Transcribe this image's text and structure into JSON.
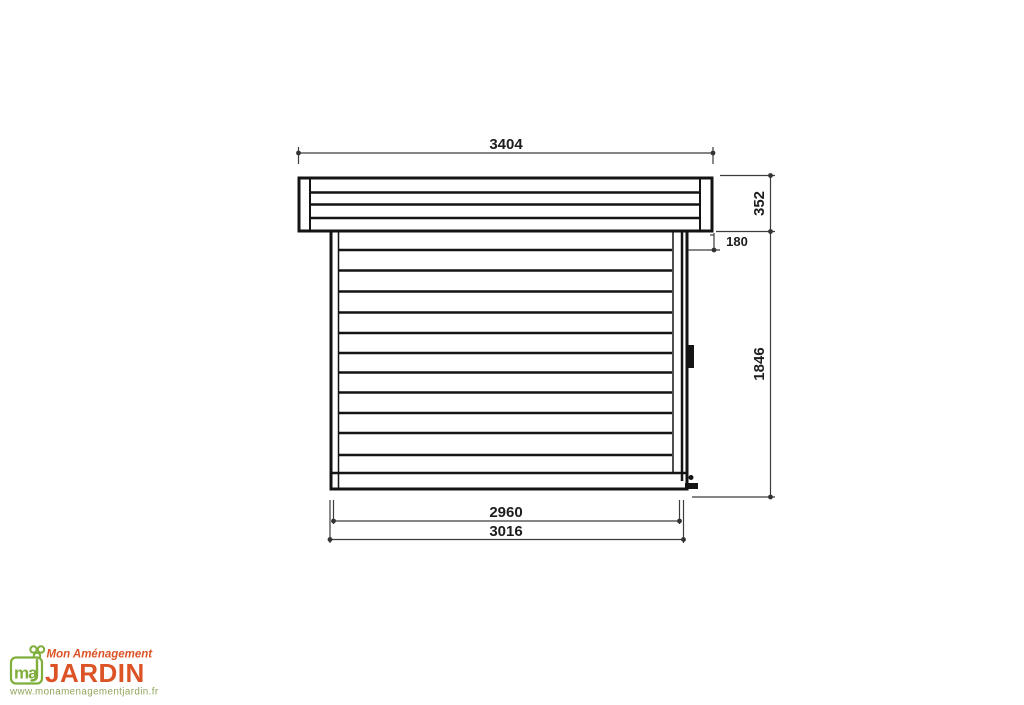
{
  "drawing": {
    "dims": {
      "roof_width": "3404",
      "roof_thickness": "352",
      "top_trim_height": "180",
      "wall_height": "1846",
      "wall_width": "2960",
      "base_width": "3016"
    },
    "colors": {
      "line": "#141414",
      "dim_line": "#3c3c3c"
    }
  },
  "logo": {
    "brand_top": "Mon Aménagement",
    "brand_main": "JARDIN",
    "monogram": "ma",
    "url": "www.monamenagementjardin.fr",
    "colors": {
      "orange": "#DC5426",
      "green": "#7FAE3A",
      "url_green": "#8FA55C"
    }
  }
}
